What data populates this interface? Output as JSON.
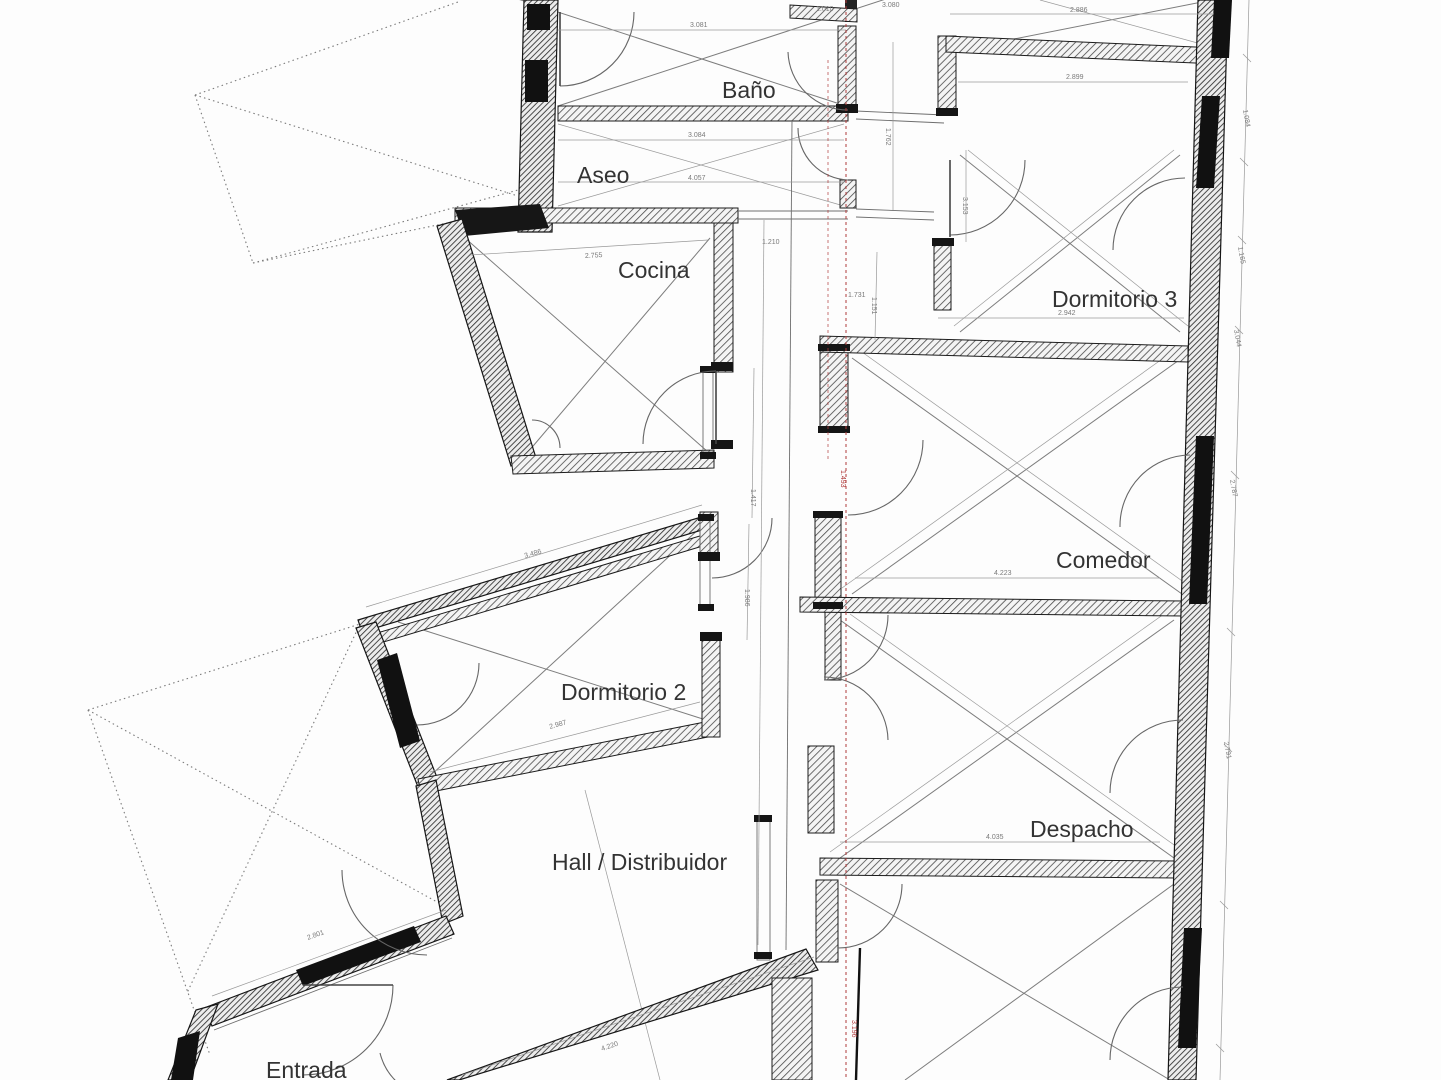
{
  "drawing": {
    "type": "architectural-floor-plan",
    "colors": {
      "paper": "#fdfdfd",
      "wall_outline": "#1c1c1c",
      "hatch": "#3d3d3d",
      "thin_line": "#6e6e6e",
      "dim_line": "#999999",
      "dim_text": "#7a7a7a",
      "axis_red": "#b03a3a",
      "label_text": "#333333"
    }
  },
  "rooms": [
    {
      "name": "Baño"
    },
    {
      "name": "Aseo"
    },
    {
      "name": "Cocina"
    },
    {
      "name": "Dormitorio 3"
    },
    {
      "name": "Comedor"
    },
    {
      "name": "Dormitorio 2"
    },
    {
      "name": "Despacho"
    },
    {
      "name": "Hall / Distribuidor"
    },
    {
      "name": "Entrada"
    }
  ],
  "dims": [
    {
      "label": "3.081"
    },
    {
      "label": "3.084"
    },
    {
      "label": "4.057"
    },
    {
      "label": "1.010"
    },
    {
      "label": "3.080"
    },
    {
      "label": "2.886"
    },
    {
      "label": "2.899"
    },
    {
      "label": "2.942"
    },
    {
      "label": "1.762"
    },
    {
      "label": "3.153"
    },
    {
      "label": "1.151"
    },
    {
      "label": "2.755"
    },
    {
      "label": "1.210"
    },
    {
      "label": "1.731"
    },
    {
      "label": "4.223"
    },
    {
      "label": "4.035"
    },
    {
      "label": "4.220"
    },
    {
      "label": "2.801"
    },
    {
      "label": "3.486"
    },
    {
      "label": "2.987"
    },
    {
      "label": "1.084"
    },
    {
      "label": "1.165"
    },
    {
      "label": "3.044"
    },
    {
      "label": "2.787"
    },
    {
      "label": "2.791"
    },
    {
      "label": "1.417"
    },
    {
      "label": "1.986"
    },
    {
      "label": "1.493"
    },
    {
      "label": "3.196"
    }
  ]
}
